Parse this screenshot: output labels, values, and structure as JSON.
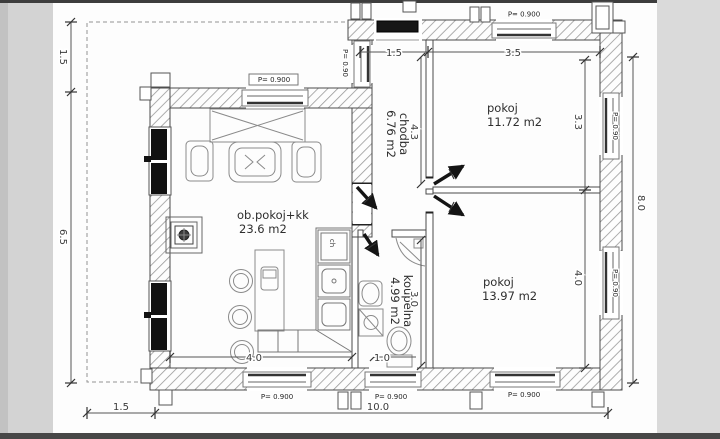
{
  "drawing": {
    "type": "floor-plan",
    "rooms": [
      {
        "name": "ob.pokoj+kk",
        "area": "23.6 m2"
      },
      {
        "name": "pokoj",
        "area": "11.72 m2"
      },
      {
        "name": "pokoj",
        "area": "13.97 m2"
      },
      {
        "name": "chodba",
        "area": "6.76 m2"
      },
      {
        "name": "koupelna",
        "area": "4.99 m2"
      }
    ],
    "dims": {
      "terrace_width": "1.5",
      "left_height": "6.5",
      "right_height": "8.0",
      "bottom_terrace": "1.5",
      "total_width": "10.0",
      "hall_width": "1.5",
      "room1_width": "3.5",
      "hall_length": "4.3",
      "room1_height": "3.3",
      "room2_height": "4.0",
      "bath_height": "3.0",
      "living_width": "4.0",
      "wc_width": "1.0"
    },
    "window_labels": {
      "parapet": "P= 0.900",
      "parapet_short": "P= 0.90"
    },
    "appliance_labels": {
      "fridge": "ch"
    }
  }
}
